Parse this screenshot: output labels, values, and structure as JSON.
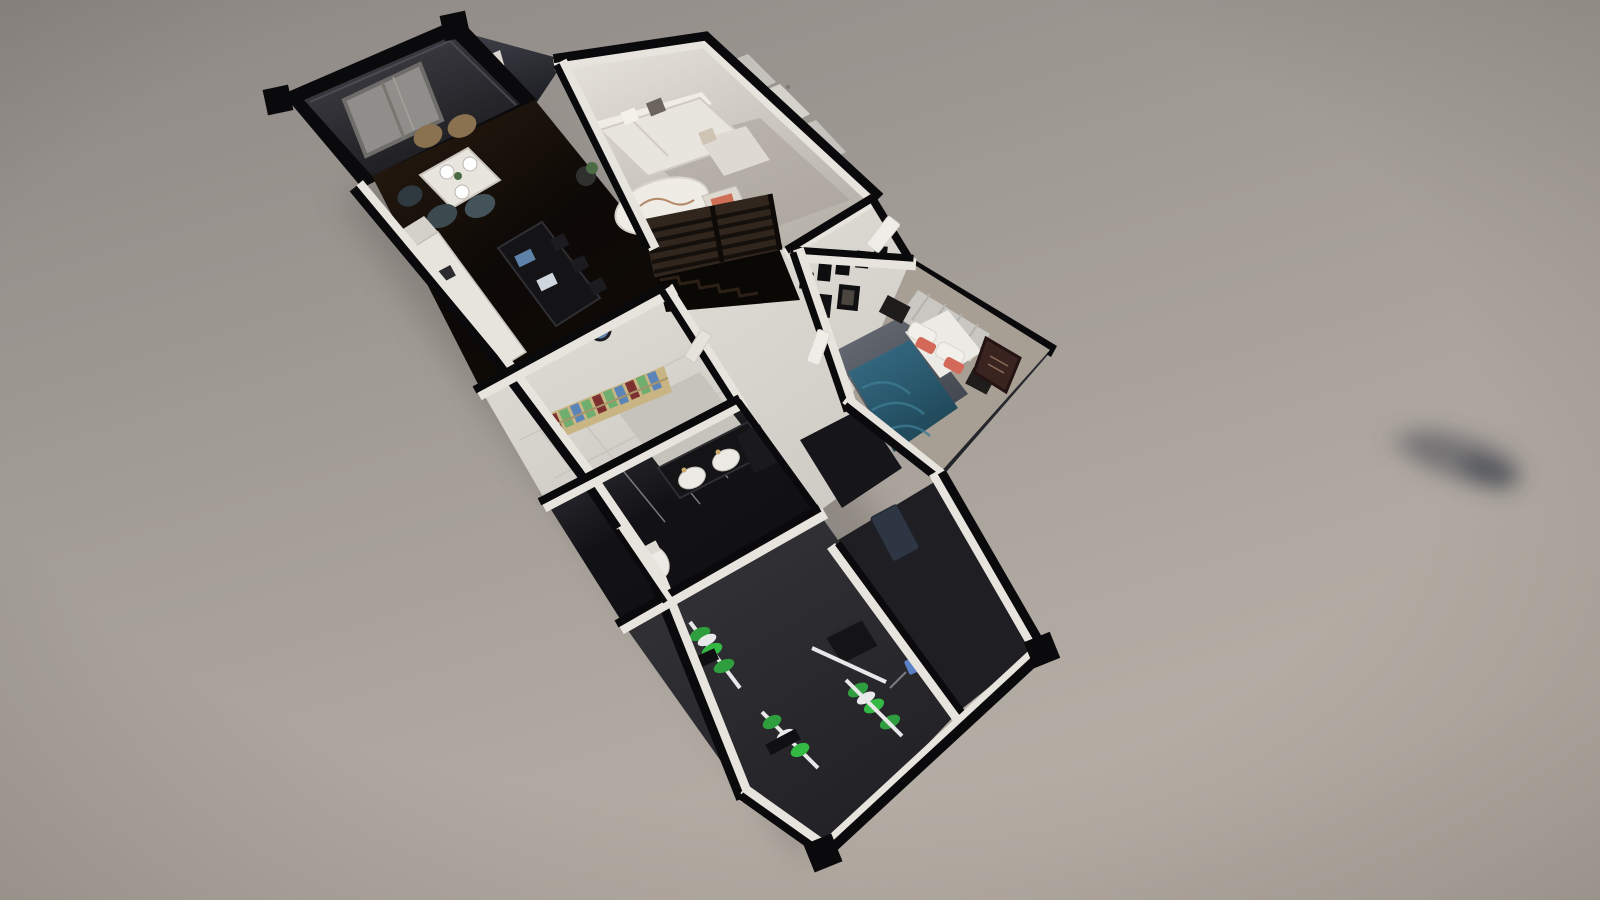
{
  "scene": {
    "title": "3D dollhouse floor-plan render of an apartment, viewed from above at a diagonal angle",
    "style": "architectural visualization, cut-away walls, no visible text or UI chrome",
    "rooms": [
      {
        "name": "terrace-balcony",
        "position": "top-left",
        "feature": "woven gray mat, dark railing, corner posts"
      },
      {
        "name": "dining-kitchen",
        "position": "upper-left interior",
        "feature": "dark herringbone floor, white dining table with place settings, dark kitchen island with bar stools, white L-counter"
      },
      {
        "name": "living-room",
        "position": "top-right",
        "feature": "white sectional sofa, oval marble coffee table, accent chair with terracotta pillow, curtained windows"
      },
      {
        "name": "staircase",
        "position": "center",
        "feature": "dark wood slatted railing, descending steps"
      },
      {
        "name": "hallway",
        "position": "center",
        "feature": "white walls, doors"
      },
      {
        "name": "bedroom",
        "position": "right wing",
        "feature": "teal duvet bed, white pillows with coral accents, gray marble rug, gallery frame wall, curtain headboard"
      },
      {
        "name": "closet-room",
        "position": "middle-left",
        "feature": "wooden bookshelf with colorful books, tiled floor, gray wardrobe panel"
      },
      {
        "name": "bathroom",
        "position": "center-lower",
        "feature": "dark floor, double round-sink vanity, tall dark cabinet, white toilet"
      },
      {
        "name": "gym",
        "position": "bottom",
        "feature": "dark carpet, green weight plates, white barbells, black benches"
      },
      {
        "name": "shower-laundry-room",
        "position": "bottom-right",
        "feature": "dark floor, small blue wall fixture, white tiled walls"
      }
    ],
    "background": "warm gray gradient backdrop with a blurred dark smudge at mid-right"
  },
  "colors": {
    "bg_top": "#8d8884",
    "bg_mid": "#a29c96",
    "bg_bottom": "#b8b0a7",
    "wall_black": "#0a0a0c",
    "wall_white": "#e7e4dd",
    "wall_white_shade": "#cfccc5",
    "ext_slab_light": "#42434b",
    "ext_slab_dark": "#212228",
    "terrace_light": "#44444b",
    "terrace_dark": "#1a1a1e",
    "mat_gray": "#8f8e8a",
    "wood_dark_lit": "#2b1d12",
    "wood_dark": "#0d0906",
    "living_floor_lit": "#e8e5de",
    "living_floor_shade": "#b7b2aa",
    "hall_floor": "#d6d3cc",
    "tile_floor": "#d9d6cf",
    "bath_floor_lit": "#3c3c44",
    "bath_floor": "#121216",
    "gym_carpet_lit": "#35353a",
    "gym_carpet": "#222226",
    "sofa_white": "#e8e5de",
    "coffee_table": "#efece6",
    "accent_pillow": "#cf6f55",
    "duvet_teal_light": "#38708a",
    "duvet_teal": "#1e4555",
    "sheet_white": "#eceae4",
    "coral_pillow": "#d4695a",
    "rug_light": "#6a6f78",
    "rug_dark": "#3f434b",
    "curtain_gray": "#c9c7c1",
    "shelf_tan": "#c9b483",
    "book_green": "#6fae6f",
    "book_blue": "#5b84b8",
    "book_maroon": "#7c3030",
    "vanity_black": "#141417",
    "sink_white": "#eceae5",
    "gym_green": "#2e9e3e",
    "gym_green_bright": "#35b945",
    "bar_white": "#e8e8e8",
    "stool_blue": "#5f82a8",
    "chair_tan": "#8a7150",
    "railing_wood": "#31261d",
    "smudge": "#3d424e",
    "door_navy": "#2e3644",
    "fixture_blue": "#5b7fc4"
  }
}
